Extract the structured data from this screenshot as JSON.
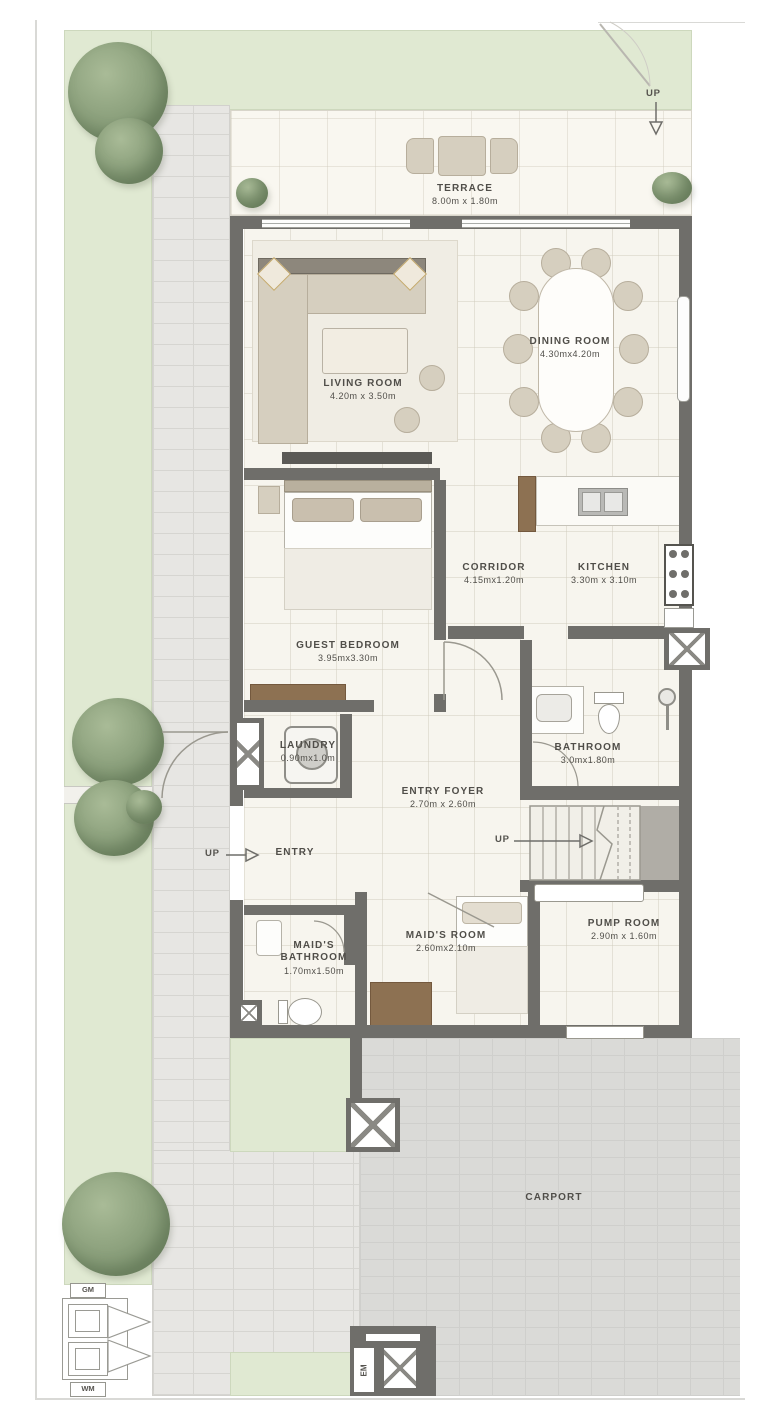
{
  "plan": {
    "rooms": [
      {
        "name": "TERRACE",
        "dims": "8.00m x 1.80m"
      },
      {
        "name": "LIVING ROOM",
        "dims": "4.20m x 3.50m"
      },
      {
        "name": "DINING ROOM",
        "dims": "4.30mx4.20m"
      },
      {
        "name": "CORRIDOR",
        "dims": "4.15mx1.20m"
      },
      {
        "name": "KITCHEN",
        "dims": "3.30m x 3.10m"
      },
      {
        "name": "GUEST BEDROOM",
        "dims": "3.95mx3.30m"
      },
      {
        "name": "LAUNDRY",
        "dims": "0.90mx1.0m"
      },
      {
        "name": "BATHROOM",
        "dims": "3.0mx1.80m"
      },
      {
        "name": "ENTRY FOYER",
        "dims": "2.70m x 2.60m"
      },
      {
        "name": "ENTRY",
        "dims": ""
      },
      {
        "name": "MAID'S BATHROOM",
        "dims": "1.70mx1.50m"
      },
      {
        "name": "MAID'S ROOM",
        "dims": "2.60mx2.10m"
      },
      {
        "name": "PUMP ROOM",
        "dims": "2.90m x 1.60m"
      },
      {
        "name": "CARPORT",
        "dims": ""
      }
    ],
    "annotations": {
      "up": "UP",
      "gm": "GM",
      "wm": "WM",
      "em": "EM"
    },
    "colors": {
      "wall": "#6f6e6a",
      "lawn": "#e0e9d2",
      "paver": "#e7e6e3",
      "carport": "#dadad7",
      "floor": "#f7f5ee",
      "wood": "#8d7152",
      "text": "#504e49"
    }
  }
}
